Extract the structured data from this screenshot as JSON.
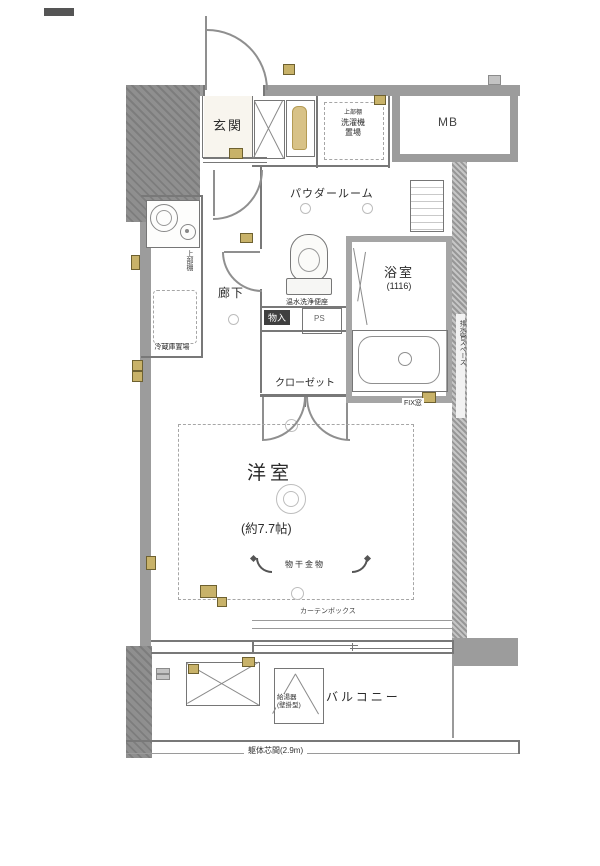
{
  "labels": {
    "genkan": "玄関",
    "mb": "MB",
    "laundry": {
      "shelf": "上部棚",
      "line1": "洗濯機",
      "line2": "置場"
    },
    "powder_room": "パウダールーム",
    "bathroom": {
      "name": "浴室",
      "size": "(1116)"
    },
    "hallway": "廊下",
    "toilet_note": "温水洗浄便座",
    "kitchen": {
      "shelf": "上部棚",
      "fridge": "冷蔵庫置場"
    },
    "storage": "物入",
    "ps": "PS",
    "closet": "クローゼット",
    "fix_window": "FIX窓",
    "pipe_note": "排水管スペース",
    "room": {
      "name": "洋室",
      "size": "(約7.7帖)"
    },
    "hanger": "物干金物",
    "curtain_box": "カーテンボックス",
    "balcony": "バルコニー",
    "water_heater": {
      "line1": "給湯器",
      "line2": "(壁掛型)"
    },
    "dimension": "躯体芯間(2.9m)"
  }
}
